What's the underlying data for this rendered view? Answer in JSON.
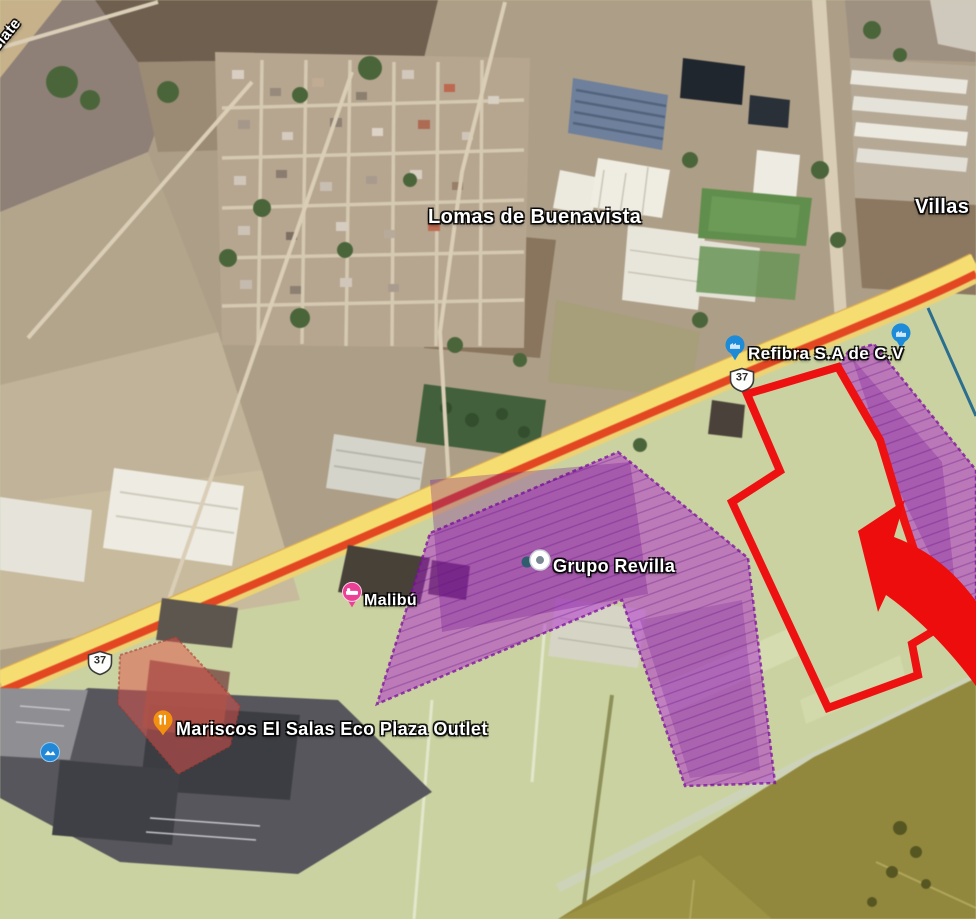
{
  "map": {
    "area_labels": {
      "lomas": "Lomas de Buenavista",
      "villas": "Villas",
      "road_fragment": "clate"
    },
    "poi": {
      "refibra": "Refibra S.A de C.V",
      "grupo_revilla": "Grupo Revilla",
      "malibu": "Malibú",
      "mariscos": "Mariscos El Salas Eco Plaza Outlet"
    },
    "route": {
      "number": "37"
    },
    "colors": {
      "zone_purple": "#ab1ed1",
      "zone_salmon": "#e0524a",
      "zone_olive": "#93883a",
      "parcel_outline_red": "#ed1111",
      "arrow_red": "#ee0d0d",
      "highway_yellow": "#f7dd6d",
      "highway_red_stripe": "#e8461f",
      "marker_blue": "#1d8bd8",
      "marker_pink": "#ec3f96",
      "marker_orange": "#f2910f",
      "boundary_blue": "#2c6e8e"
    }
  }
}
